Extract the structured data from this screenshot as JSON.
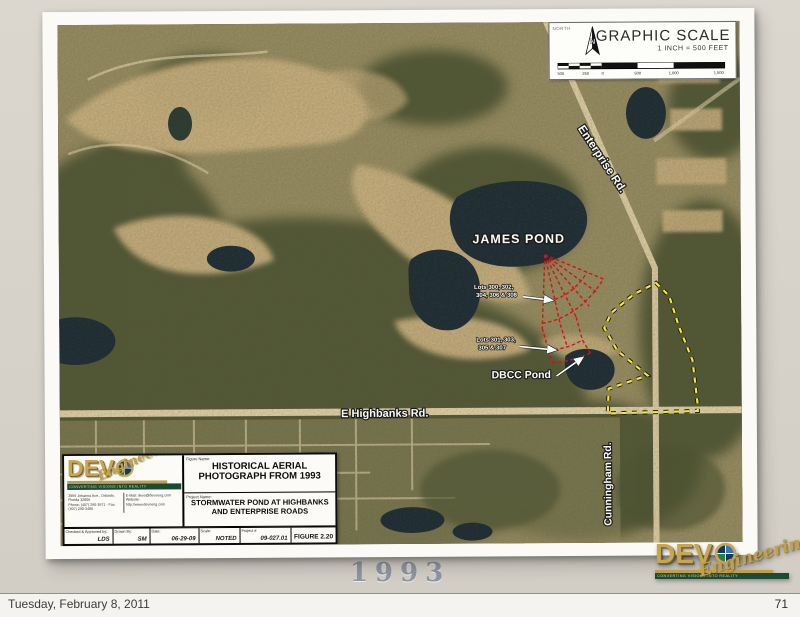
{
  "slide": {
    "caption": "1993"
  },
  "footer": {
    "date": "Tuesday, February 8, 2011",
    "page": "71"
  },
  "scale_box": {
    "north_tag": "NORTH",
    "title": "GRAPHIC SCALE",
    "subtitle": "1 INCH = 500 FEET",
    "ticks": [
      "500",
      "250",
      "0",
      "500",
      "1,000",
      "1,500"
    ]
  },
  "map": {
    "annotations": {
      "james_pond": "JAMES POND",
      "lots_even_l1": "Lots 300, 302,",
      "lots_even_l2": "304, 306 & 308",
      "lots_odd_l1": "Lots 301, 303,",
      "lots_odd_l2": "305 & 307",
      "dbcc_pond": "DBCC Pond"
    },
    "roads": {
      "enterprise": "Enterprise Rd.",
      "highbanks": "E Highbanks Rd.",
      "cunningham": "Cunningham Rd."
    },
    "colors": {
      "lot_lines": "#d01414",
      "parcel_boundary": "#f2e838"
    }
  },
  "title_block": {
    "figure_label": "Figure Name:",
    "figure_name": "HISTORICAL AERIAL PHOTOGRAPH FROM 1993",
    "project_label": "Project Name:",
    "project_name": "STORMWATER POND AT HIGHBANKS AND ENTERPRISE ROADS",
    "checked_label": "Checked & Approved by:",
    "checked_value": "LDS",
    "drawn_label": "Drawn By:",
    "drawn_value": "SM",
    "date_label": "Date:",
    "date_value": "06-29-09",
    "scale_label": "Scale:",
    "scale_value": "NOTED",
    "project_no_label": "Project #",
    "project_no_value": "09-027.01",
    "figure_no": "FIGURE 2.20"
  },
  "brand": {
    "prefix": "DEV",
    "script": "Engineering",
    "tagline": "CONVERTING VISIONS INTO REALITY",
    "addr_line1": "3959 Johanna Ave., Orlando, Florida 32806",
    "addr_line2": "Phone: (407) 290-3971 - Fax: (407) 290-3480",
    "addr_line3": "E-Mail: devo@devoeng.com",
    "addr_line4": "Website: http://www.devoeng.com"
  }
}
